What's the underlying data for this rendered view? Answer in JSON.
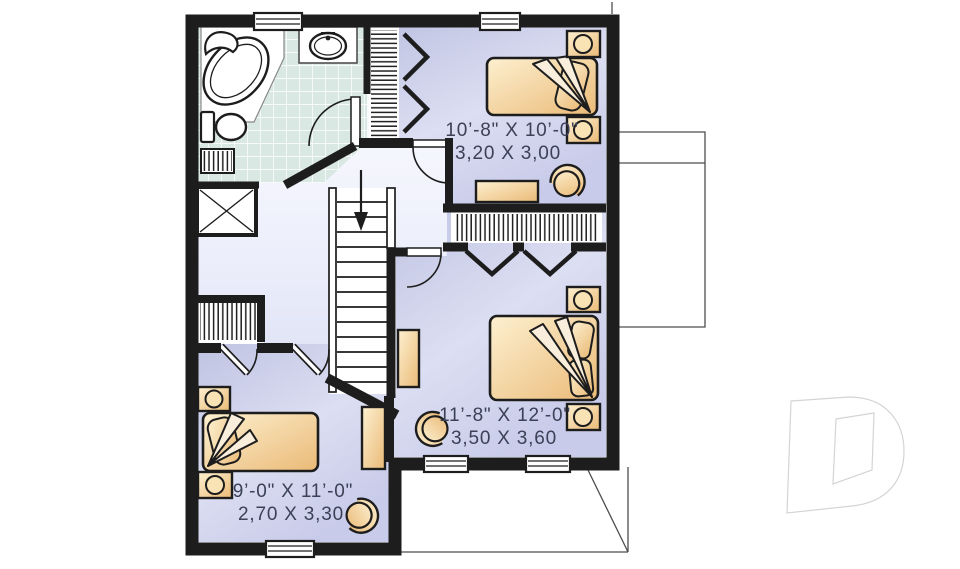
{
  "floor_plan": {
    "rooms": [
      {
        "name": "bedroom-top-right",
        "imperial": "10’-8\" X 10’-0\"",
        "metric": "3,20 X 3,00"
      },
      {
        "name": "bedroom-bottom-right",
        "imperial": "11’-8\" X 12’-0\"",
        "metric": "3,50 X 3,60"
      },
      {
        "name": "bedroom-bottom-left",
        "imperial": "9’-0\" X 11’-0\"",
        "metric": "2,70 X 3,30"
      }
    ],
    "features": [
      "bathtub",
      "bathroom-sink",
      "toilet",
      "bathroom-cabinet",
      "linen-closet",
      "staircase",
      "stairs-down-arrow",
      "hatched-closets",
      "bifold-doors",
      "beds",
      "pillows",
      "blanket-folds",
      "nightstands",
      "dressers",
      "armchairs",
      "windows",
      "door-swings"
    ],
    "colors": {
      "wall": "#1d1d1d",
      "room_fill": "#c6c9e7",
      "room_fill_light": "#e2e4f5",
      "hall_top": "#ffffff",
      "hall_bottom": "#ccd0ec",
      "tile": "#d9e8e3",
      "furniture_light": "#fdf0d0",
      "furniture_dark": "#eaba77",
      "dimension_text": "#3b4156",
      "projection_line": "#4d4d4d",
      "watermark_outline": "#d4d4d4"
    }
  },
  "watermark": {
    "name": "builder-logo-d"
  }
}
